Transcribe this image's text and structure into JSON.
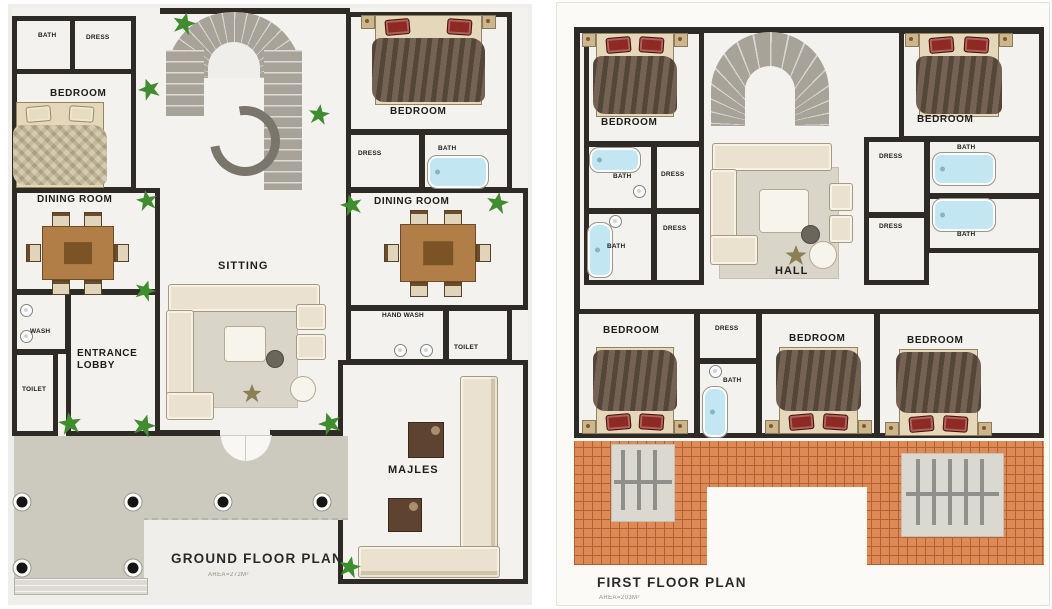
{
  "ground": {
    "title": "GROUND FLOOR PLAN",
    "subtitle": "AREA=272M²",
    "rooms": [
      {
        "label": "BATH"
      },
      {
        "label": "DRESS"
      },
      {
        "label": "BEDROOM"
      },
      {
        "label": "DINING ROOM"
      },
      {
        "label": "WASH"
      },
      {
        "label": "ENTRANCE LOBBY"
      },
      {
        "label": "TOILET"
      },
      {
        "label": "SITTING"
      },
      {
        "label": "BEDROOM"
      },
      {
        "label": "DRESS"
      },
      {
        "label": "BATH"
      },
      {
        "label": "DINING ROOM"
      },
      {
        "label": "HAND WASH"
      },
      {
        "label": "TOILET"
      },
      {
        "label": "MAJLES"
      }
    ]
  },
  "first": {
    "title": "FIRST FLOOR PLAN",
    "subtitle": "AREA=203M²",
    "rooms": [
      {
        "label": "BEDROOM"
      },
      {
        "label": "BATH"
      },
      {
        "label": "DRESS"
      },
      {
        "label": "BATH"
      },
      {
        "label": "DRESS"
      },
      {
        "label": "HALL"
      },
      {
        "label": "BEDROOM"
      },
      {
        "label": "DRESS"
      },
      {
        "label": "BATH"
      },
      {
        "label": "DRESS"
      },
      {
        "label": "BATH"
      },
      {
        "label": "BEDROOM"
      },
      {
        "label": "DRESS"
      },
      {
        "label": "BATH"
      },
      {
        "label": "BEDROOM"
      },
      {
        "label": "BEDROOM"
      }
    ]
  },
  "colors": {
    "wall": "#2e2a26",
    "panel_left": "#efeeea",
    "panel_right": "#fbfaf7",
    "floor": "#f4f2ee",
    "porch": "#ccc9bf",
    "steps": "#dedbd2",
    "stairs": "#a8a399",
    "tile": "#dd8a57",
    "tile_line": "#b4602f",
    "plant": "#3e8e2d",
    "bed_frame": "#e5d7ba",
    "blanket": "#6a5748",
    "pillow": "#8e2a23",
    "wood": "#b07e46",
    "water": "#c3e7f2",
    "sofa": "#eae2cf",
    "rug": "#d9d5c9"
  }
}
